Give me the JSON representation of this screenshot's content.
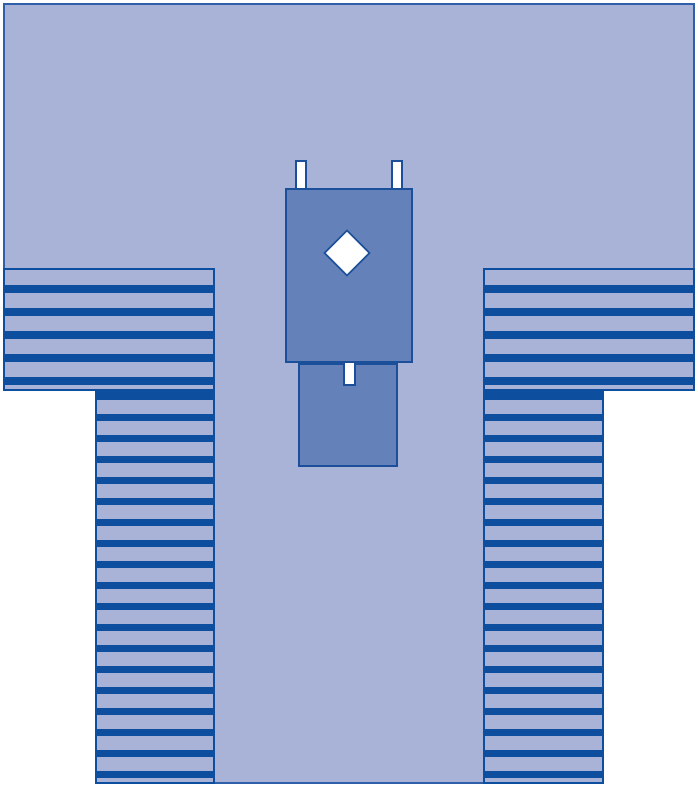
{
  "meta": {
    "title": "T-shaped surgical drape schematic",
    "description": "Schematic diagram of a split-leg style drape: wide top sheet, two striped side panels (shoulder blocks continuing into leg columns), a central panel, two stacked reinforcement pads with a white diamond fenestration, two white tabs at the pad top and one white tab below the upper pad."
  },
  "colors": {
    "page_background": "#ffffff",
    "drape_fill": "#a8b3d7",
    "drape_outline": "#2e5fa8",
    "stripe": "#0d4e9e",
    "pad_fill": "#6581ba",
    "pad_outline": "#1c4f99",
    "fenestration_fill": "#ffffff"
  },
  "shapes": [
    {
      "name": "drape-top-sheet",
      "kind": "rectangle",
      "fill_key": "drape_fill"
    },
    {
      "name": "drape-center-panel",
      "kind": "rectangle",
      "fill_key": "drape_fill"
    },
    {
      "name": "left-shoulder-striped-panel",
      "kind": "striped-rectangle",
      "fill_key": "stripe"
    },
    {
      "name": "right-shoulder-striped-panel",
      "kind": "striped-rectangle",
      "fill_key": "stripe"
    },
    {
      "name": "left-leg-striped-panel",
      "kind": "striped-rectangle",
      "fill_key": "stripe"
    },
    {
      "name": "right-leg-striped-panel",
      "kind": "striped-rectangle",
      "fill_key": "stripe"
    },
    {
      "name": "upper-pad",
      "kind": "rectangle",
      "fill_key": "pad_fill"
    },
    {
      "name": "lower-pad",
      "kind": "rectangle",
      "fill_key": "pad_fill"
    },
    {
      "name": "diamond-fenestration",
      "kind": "diamond",
      "fill_key": "fenestration_fill"
    },
    {
      "name": "top-left-tab",
      "kind": "rectangle",
      "fill_key": "fenestration_fill"
    },
    {
      "name": "top-right-tab",
      "kind": "rectangle",
      "fill_key": "fenestration_fill"
    },
    {
      "name": "lower-center-tab",
      "kind": "rectangle",
      "fill_key": "fenestration_fill"
    }
  ],
  "text": {}
}
